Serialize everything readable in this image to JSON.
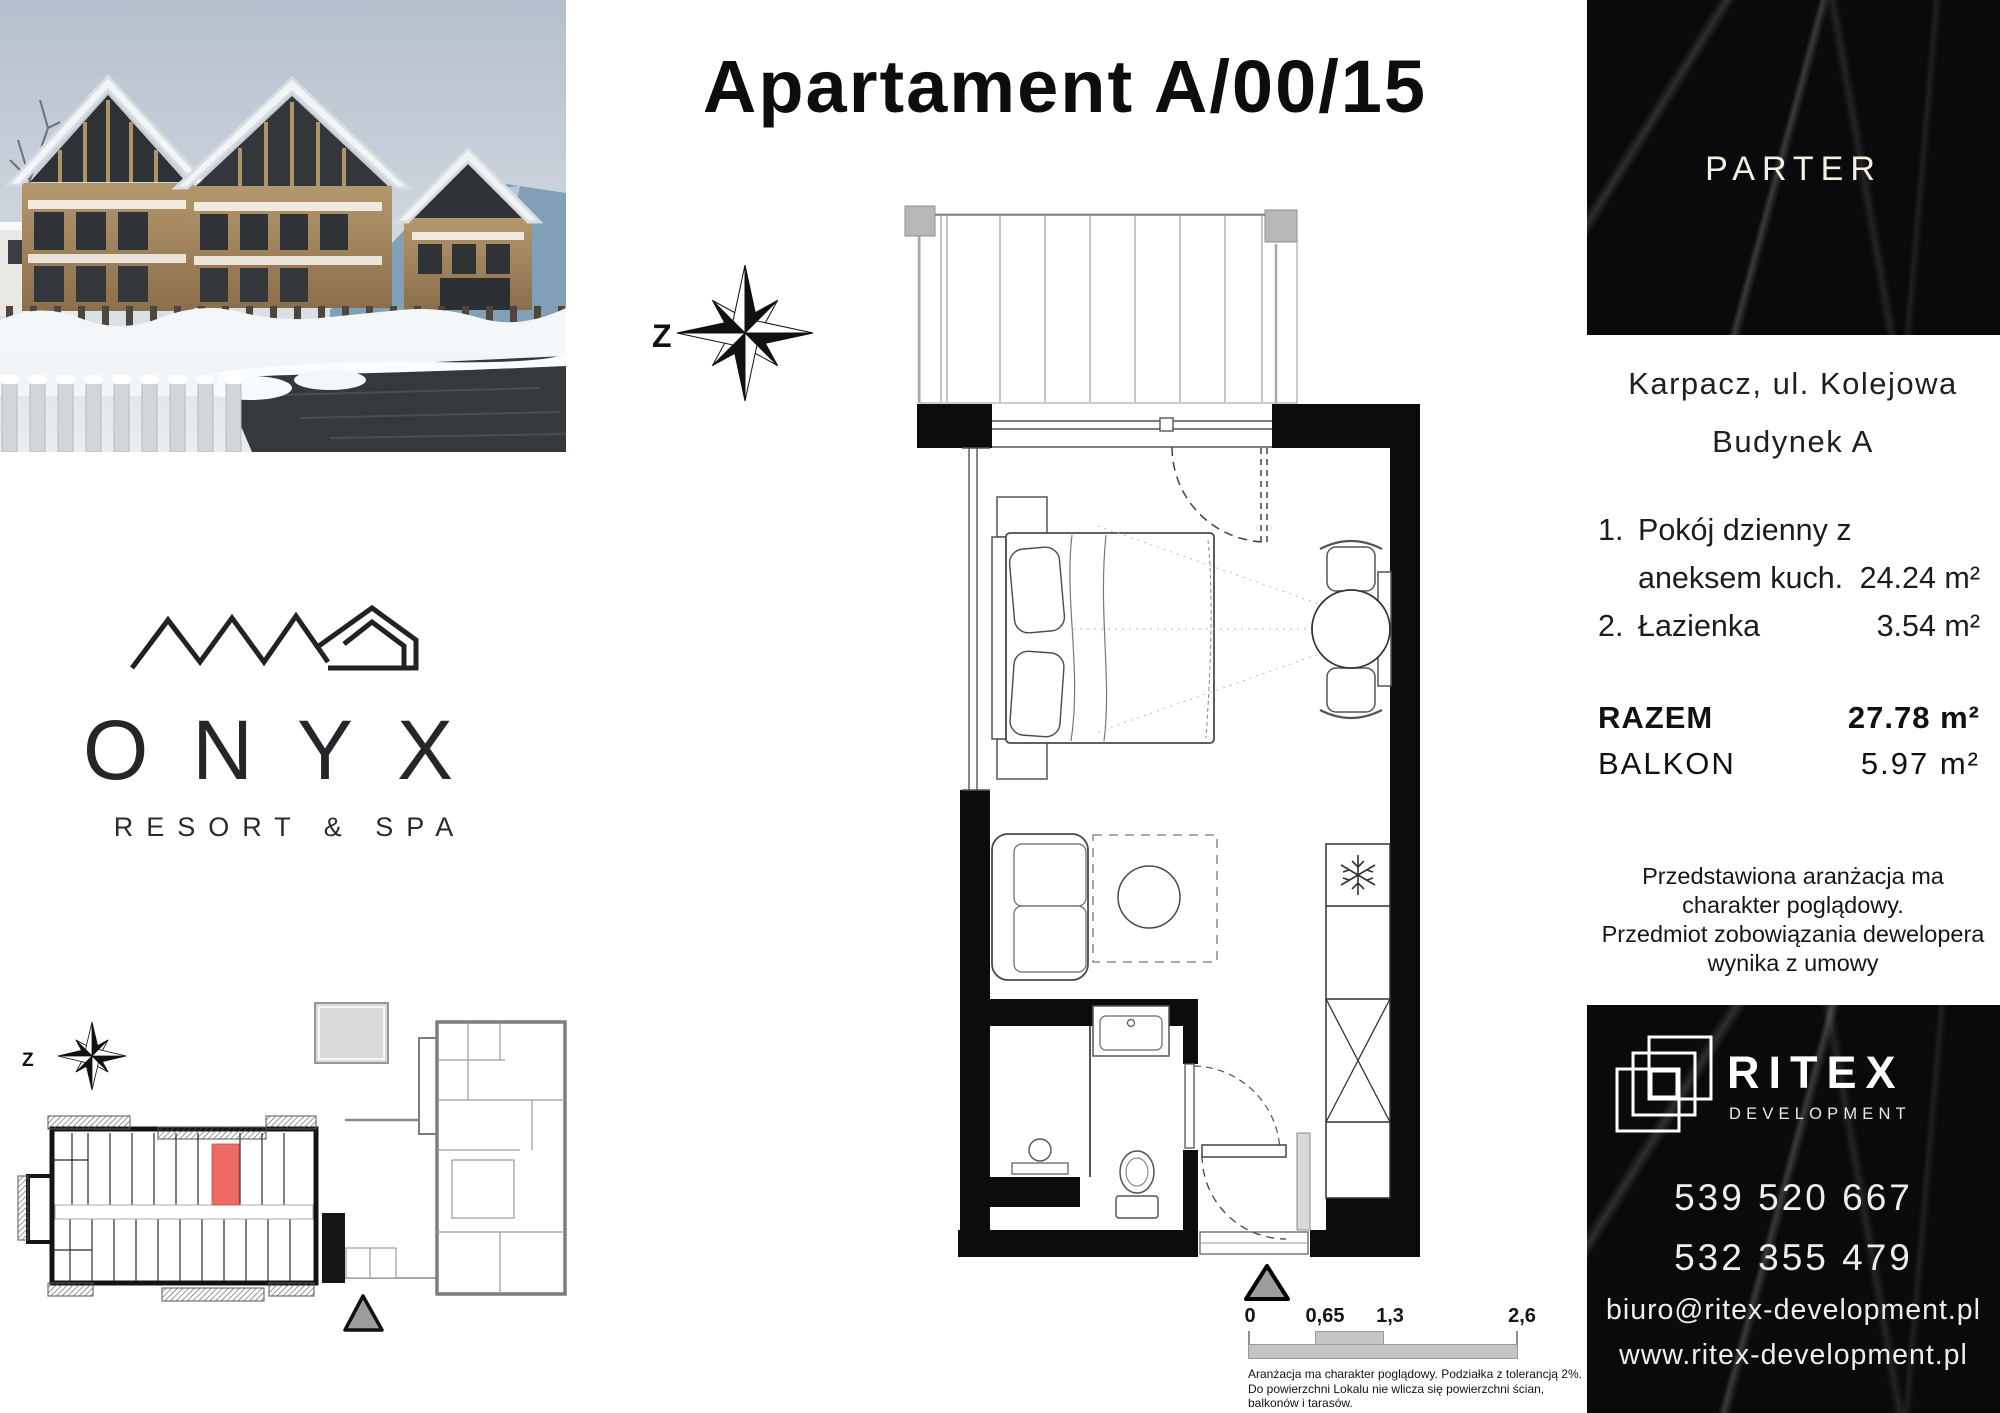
{
  "title": "Apartament A/00/15",
  "compass": {
    "west_label": "Z"
  },
  "brand": {
    "name": "ONYX",
    "subtitle": "RESORT & SPA"
  },
  "info_panel": {
    "floor_label": "PARTER",
    "address_line1": "Karpacz, ul. Kolejowa",
    "address_line2": "Budynek A",
    "rooms": [
      {
        "no": "1.",
        "name_line1": "Pokój dzienny z",
        "name_line2": "aneksem kuch.",
        "area": "24.24 m²"
      },
      {
        "no": "2.",
        "name_line1": "Łazienka",
        "name_line2": "",
        "area": "3.54 m²"
      }
    ],
    "total_label": "RAZEM",
    "total_value": "27.78 m²",
    "balcony_label": "BALKON",
    "balcony_value": "5.97 m²",
    "disclaimer_lines": [
      "Przedstawiona aranżacja ma",
      "charakter poglądowy.",
      "Przedmiot zobowiązania dewelopera",
      "wynika z umowy"
    ]
  },
  "developer": {
    "name": "RITEX",
    "name_sub": "DEVELOPMENT",
    "phone1": "539 520 667",
    "phone2": "532 355 479",
    "email": "biuro@ritex-development.pl",
    "website": "www.ritex-development.pl"
  },
  "scale_bar": {
    "labels": [
      "0",
      "0,65",
      "1,3",
      "2,6"
    ]
  },
  "fine_print": {
    "line1": "Aranżacja ma charakter poglądowy. Podziałka z tolerancją 2%.",
    "line2": "Do powierzchni Lokalu nie wlicza się powierzchni ścian, balkonów i tarasów."
  },
  "colors": {
    "highlight_unit": "#ED6B62",
    "marble": "#0b0b0d",
    "parter_text": "#f6efe4"
  }
}
